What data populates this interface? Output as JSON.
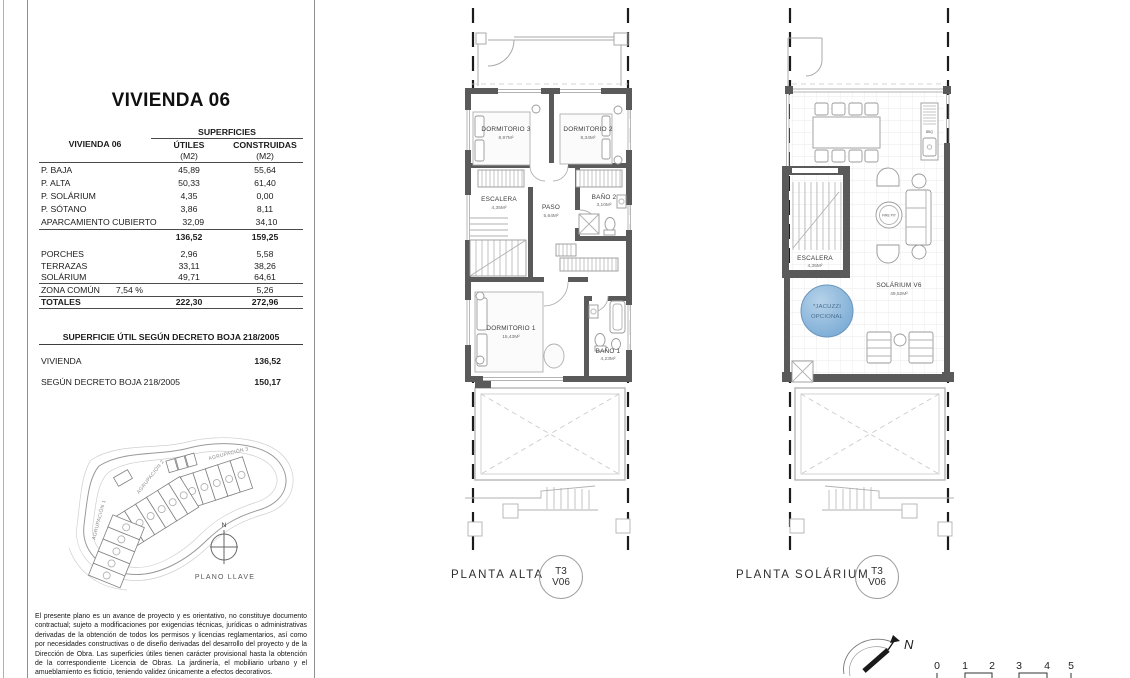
{
  "panel": {
    "title": "VIVIENDA 06",
    "surface_table": {
      "corner_label": "VIVIENDA 06",
      "group_header": "SUPERFICIES",
      "col_utiles": "ÚTILES",
      "col_construidas": "CONSTRUIDAS",
      "unit": "(M2)",
      "rows": [
        {
          "label": "P. BAJA",
          "utiles": "45,89",
          "construidas": "55,64"
        },
        {
          "label": "P. ALTA",
          "utiles": "50,33",
          "construidas": "61,40"
        },
        {
          "label": "P. SOLÁRIUM",
          "utiles": "4,35",
          "construidas": "0,00"
        },
        {
          "label": "P. SÓTANO",
          "utiles": "3,86",
          "construidas": "8,11"
        },
        {
          "label": "APARCAMIENTO CUBIERTO",
          "utiles": "32,09",
          "construidas": "34,10"
        }
      ],
      "subtotal": {
        "utiles": "136,52",
        "construidas": "159,25"
      },
      "outdoor_rows": [
        {
          "label": "PORCHES",
          "utiles": "2,96",
          "construidas": "5,58"
        },
        {
          "label": "TERRAZAS",
          "utiles": "33,11",
          "construidas": "38,26"
        },
        {
          "label": "SOLÁRIUM",
          "utiles": "49,71",
          "construidas": "64,61"
        }
      ],
      "zona_comun": {
        "label": "ZONA COMÚN",
        "percent": "7,54 %",
        "construidas": "5,26"
      },
      "totales": {
        "label": "TOTALES",
        "utiles": "222,30",
        "construidas": "272,96"
      }
    },
    "boja": {
      "header": "SUPERFICIE ÚTIL SEGÚN DECRETO BOJA 218/2005",
      "rows": [
        {
          "label": "VIVIENDA",
          "value": "136,52"
        },
        {
          "label": "SEGÚN DECRETO BOJA 218/2005",
          "value": "150,17"
        }
      ]
    },
    "site_plan": {
      "agrupacion1": "AGRUPACIÓN 1",
      "agrupacion2": "AGRUPACIÓN 2",
      "agrupacion3": "AGRUPACIÓN 3",
      "north": "N",
      "caption": "PLANO LLAVE"
    },
    "disclaimer": "El presente plano es un avance de proyecto y es orientativo, no constituye documento contractual; sujeto a modificaciones por exigencias técnicas, jurídicas o administrativas derivadas de la obtención de todos los permisos y licencias reglamentarios, así como por necesidades constructivas o de diseño derivadas del desarrollo del proyecto y de la Dirección de Obra. Las superficies útiles tienen carácter provisional hasta la obtención de la correspondiente Licencia de Obras. La jardinería, el mobiliario urbano y el amueblamiento es ficticio, teniendo validez únicamente a efectos decorativos."
  },
  "planta_alta": {
    "caption": "PLANTA ALTA",
    "badge": {
      "top": "T3",
      "bottom": "V06"
    },
    "rooms": {
      "dormitorio3": {
        "name": "DORMITORIO 3",
        "area": "8,97M²"
      },
      "dormitorio2": {
        "name": "DORMITORIO 2",
        "area": "8,34M²"
      },
      "escalera": {
        "name": "ESCALERA",
        "area": "4,35M²"
      },
      "paso": {
        "name": "PASO",
        "area": "5,64M²"
      },
      "bano2": {
        "name": "BAÑO 2",
        "area": "3,10M²"
      },
      "dormitorio1": {
        "name": "DORMITORIO 1",
        "area": "15,43M²"
      },
      "bano1": {
        "name": "BAÑO 1",
        "area": "4,23M²"
      }
    }
  },
  "planta_solarium": {
    "caption": "PLANTA SOLÁRIUM",
    "badge": {
      "top": "T3",
      "bottom": "V06"
    },
    "rooms": {
      "escalera": {
        "name": "ESCALERA",
        "area": "4,35M²"
      },
      "solarium": {
        "name": "SOLÁRIUM V6",
        "area": "49,52M²"
      }
    },
    "jacuzzi": {
      "line1": "*JACUZZI",
      "line2": "OPCIONAL"
    },
    "bbq": "BBQ",
    "firepit": "FIRE PIT"
  },
  "footer": {
    "north": "N",
    "scale_ticks": [
      "0",
      "1",
      "2",
      "3",
      "4",
      "5"
    ]
  },
  "colors": {
    "wall": "#5a5a5a",
    "jacuzzi_fill": "#7fb0d9",
    "jacuzzi_text": "#4a6d8f",
    "highlight_unit": "#b9abae",
    "section_line": "#1c1c1c"
  }
}
